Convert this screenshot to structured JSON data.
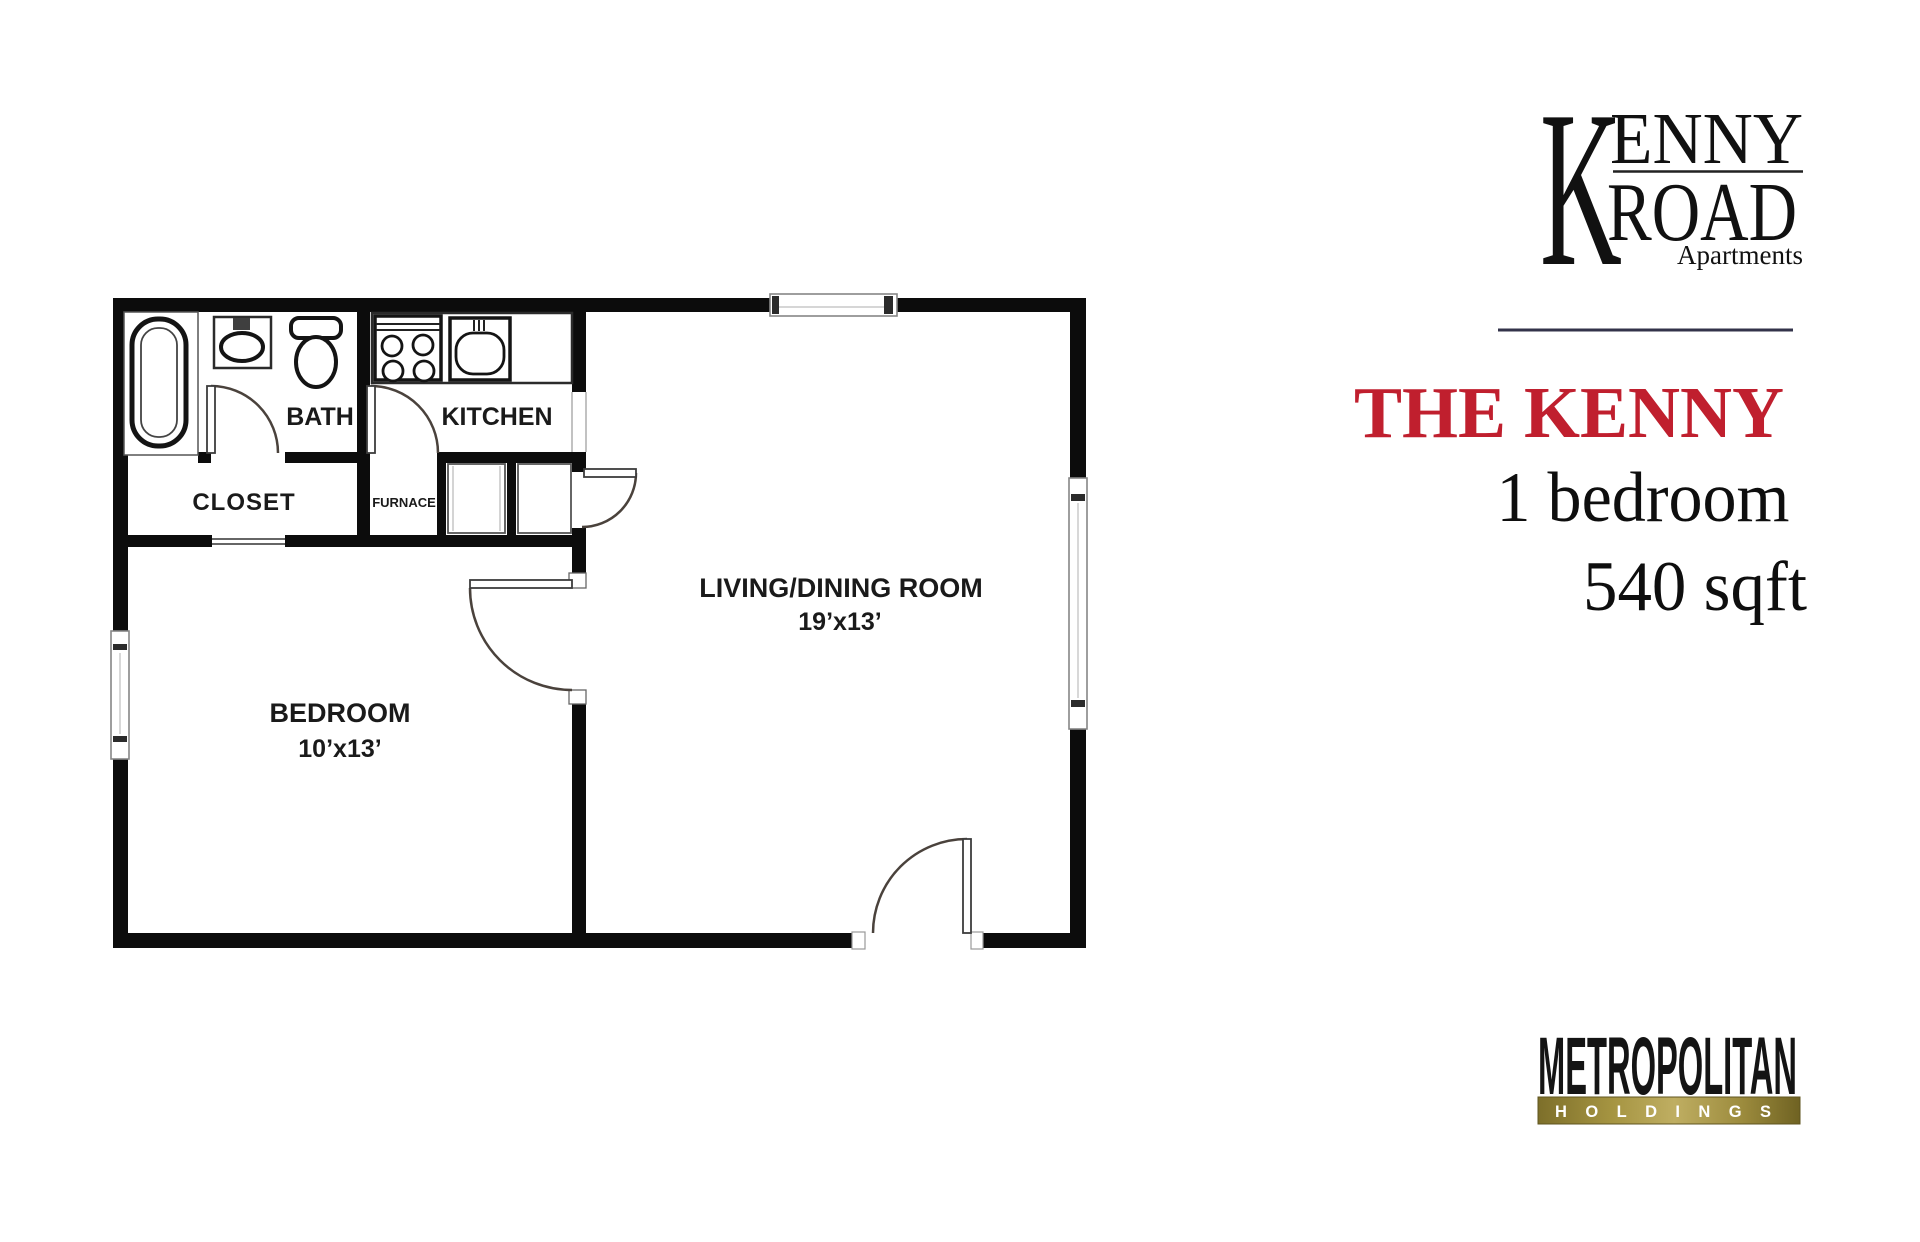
{
  "branding": {
    "kenny_road": {
      "k": "K",
      "enny": "ENNY",
      "road": "ROAD",
      "tagline": "Apartments"
    },
    "metropolitan": {
      "name": "METROPOLITAN",
      "division": "HOLDINGS"
    }
  },
  "unit": {
    "name": "THE KENNY",
    "bedrooms": "1 bedroom",
    "area": "540 sqft"
  },
  "colors": {
    "accent_red": "#c01f2e",
    "wall_black": "#0c0c0c",
    "divider_slate": "#33334a",
    "gold_dark": "#7d6f2a",
    "gold_mid": "#bfae62",
    "gold_deep": "#6f6222"
  },
  "floorplan": {
    "labels": {
      "bath": "BATH",
      "kitchen": "KITCHEN",
      "closet": "CLOSET",
      "furnace": "FURNACE",
      "living": "LIVING/DINING ROOM",
      "living_dims": "19’x13’",
      "bedroom": "BEDROOM",
      "bedroom_dims": "10’x13’"
    }
  }
}
